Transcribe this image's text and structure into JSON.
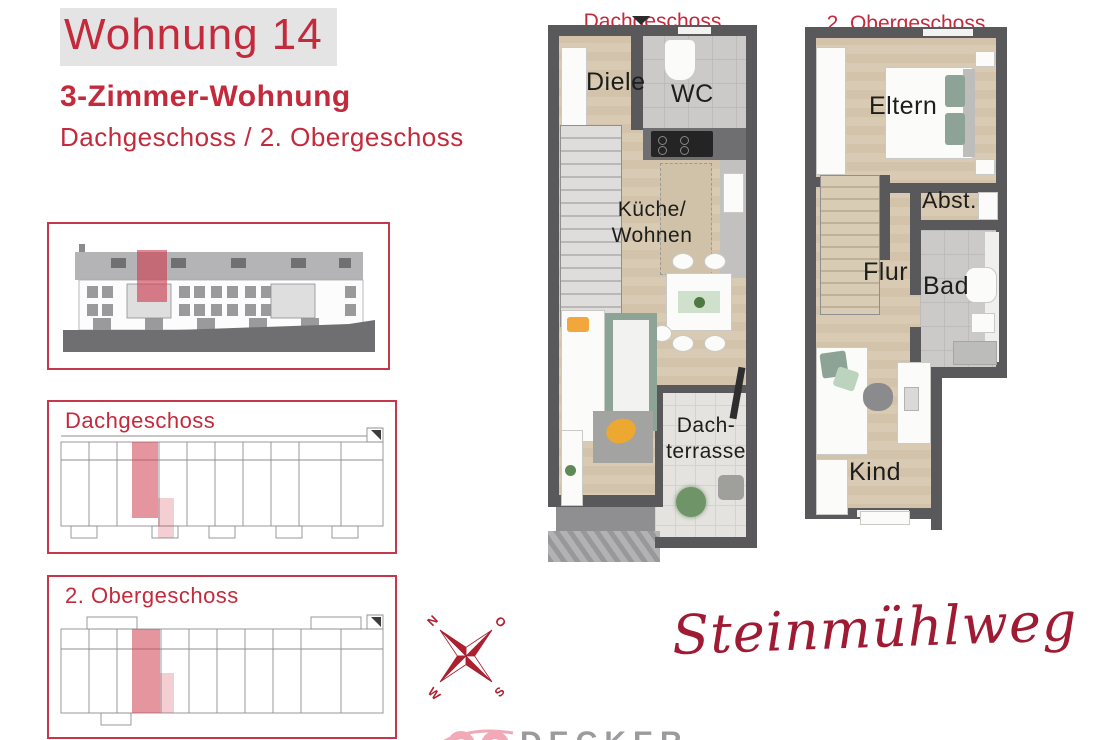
{
  "header": {
    "title": "Wohnung 14",
    "subtitle": "3-Zimmer-Wohnung",
    "floors": "Dachgeschoss / 2. Obergeschoss"
  },
  "sidebar": {
    "box2_label": "Dachgeschoss",
    "box3_label": "2. Obergeschoss"
  },
  "plans": {
    "dg": {
      "title": "Dachgeschoss",
      "rooms": {
        "diele": "Diele",
        "wc": "WC",
        "kueche_wohnen": "Küche/\nWohnen",
        "dachterrasse": "Dach-\nterrasse"
      }
    },
    "og": {
      "title": "2. Obergeschoss",
      "rooms": {
        "eltern": "Eltern",
        "abst": "Abst.",
        "flur": "Flur",
        "bad": "Bad",
        "kind": "Kind"
      }
    }
  },
  "compass": {
    "n": "N",
    "o": "O",
    "s": "S",
    "w": "W"
  },
  "branding": {
    "street": "Steinmühlweg",
    "logo": "DECKER"
  },
  "colors": {
    "accent_red": "#c32a3c",
    "script_red": "#9e1b33",
    "highlight_pink": "#cf3e4f",
    "wall_gray": "#59595b"
  }
}
